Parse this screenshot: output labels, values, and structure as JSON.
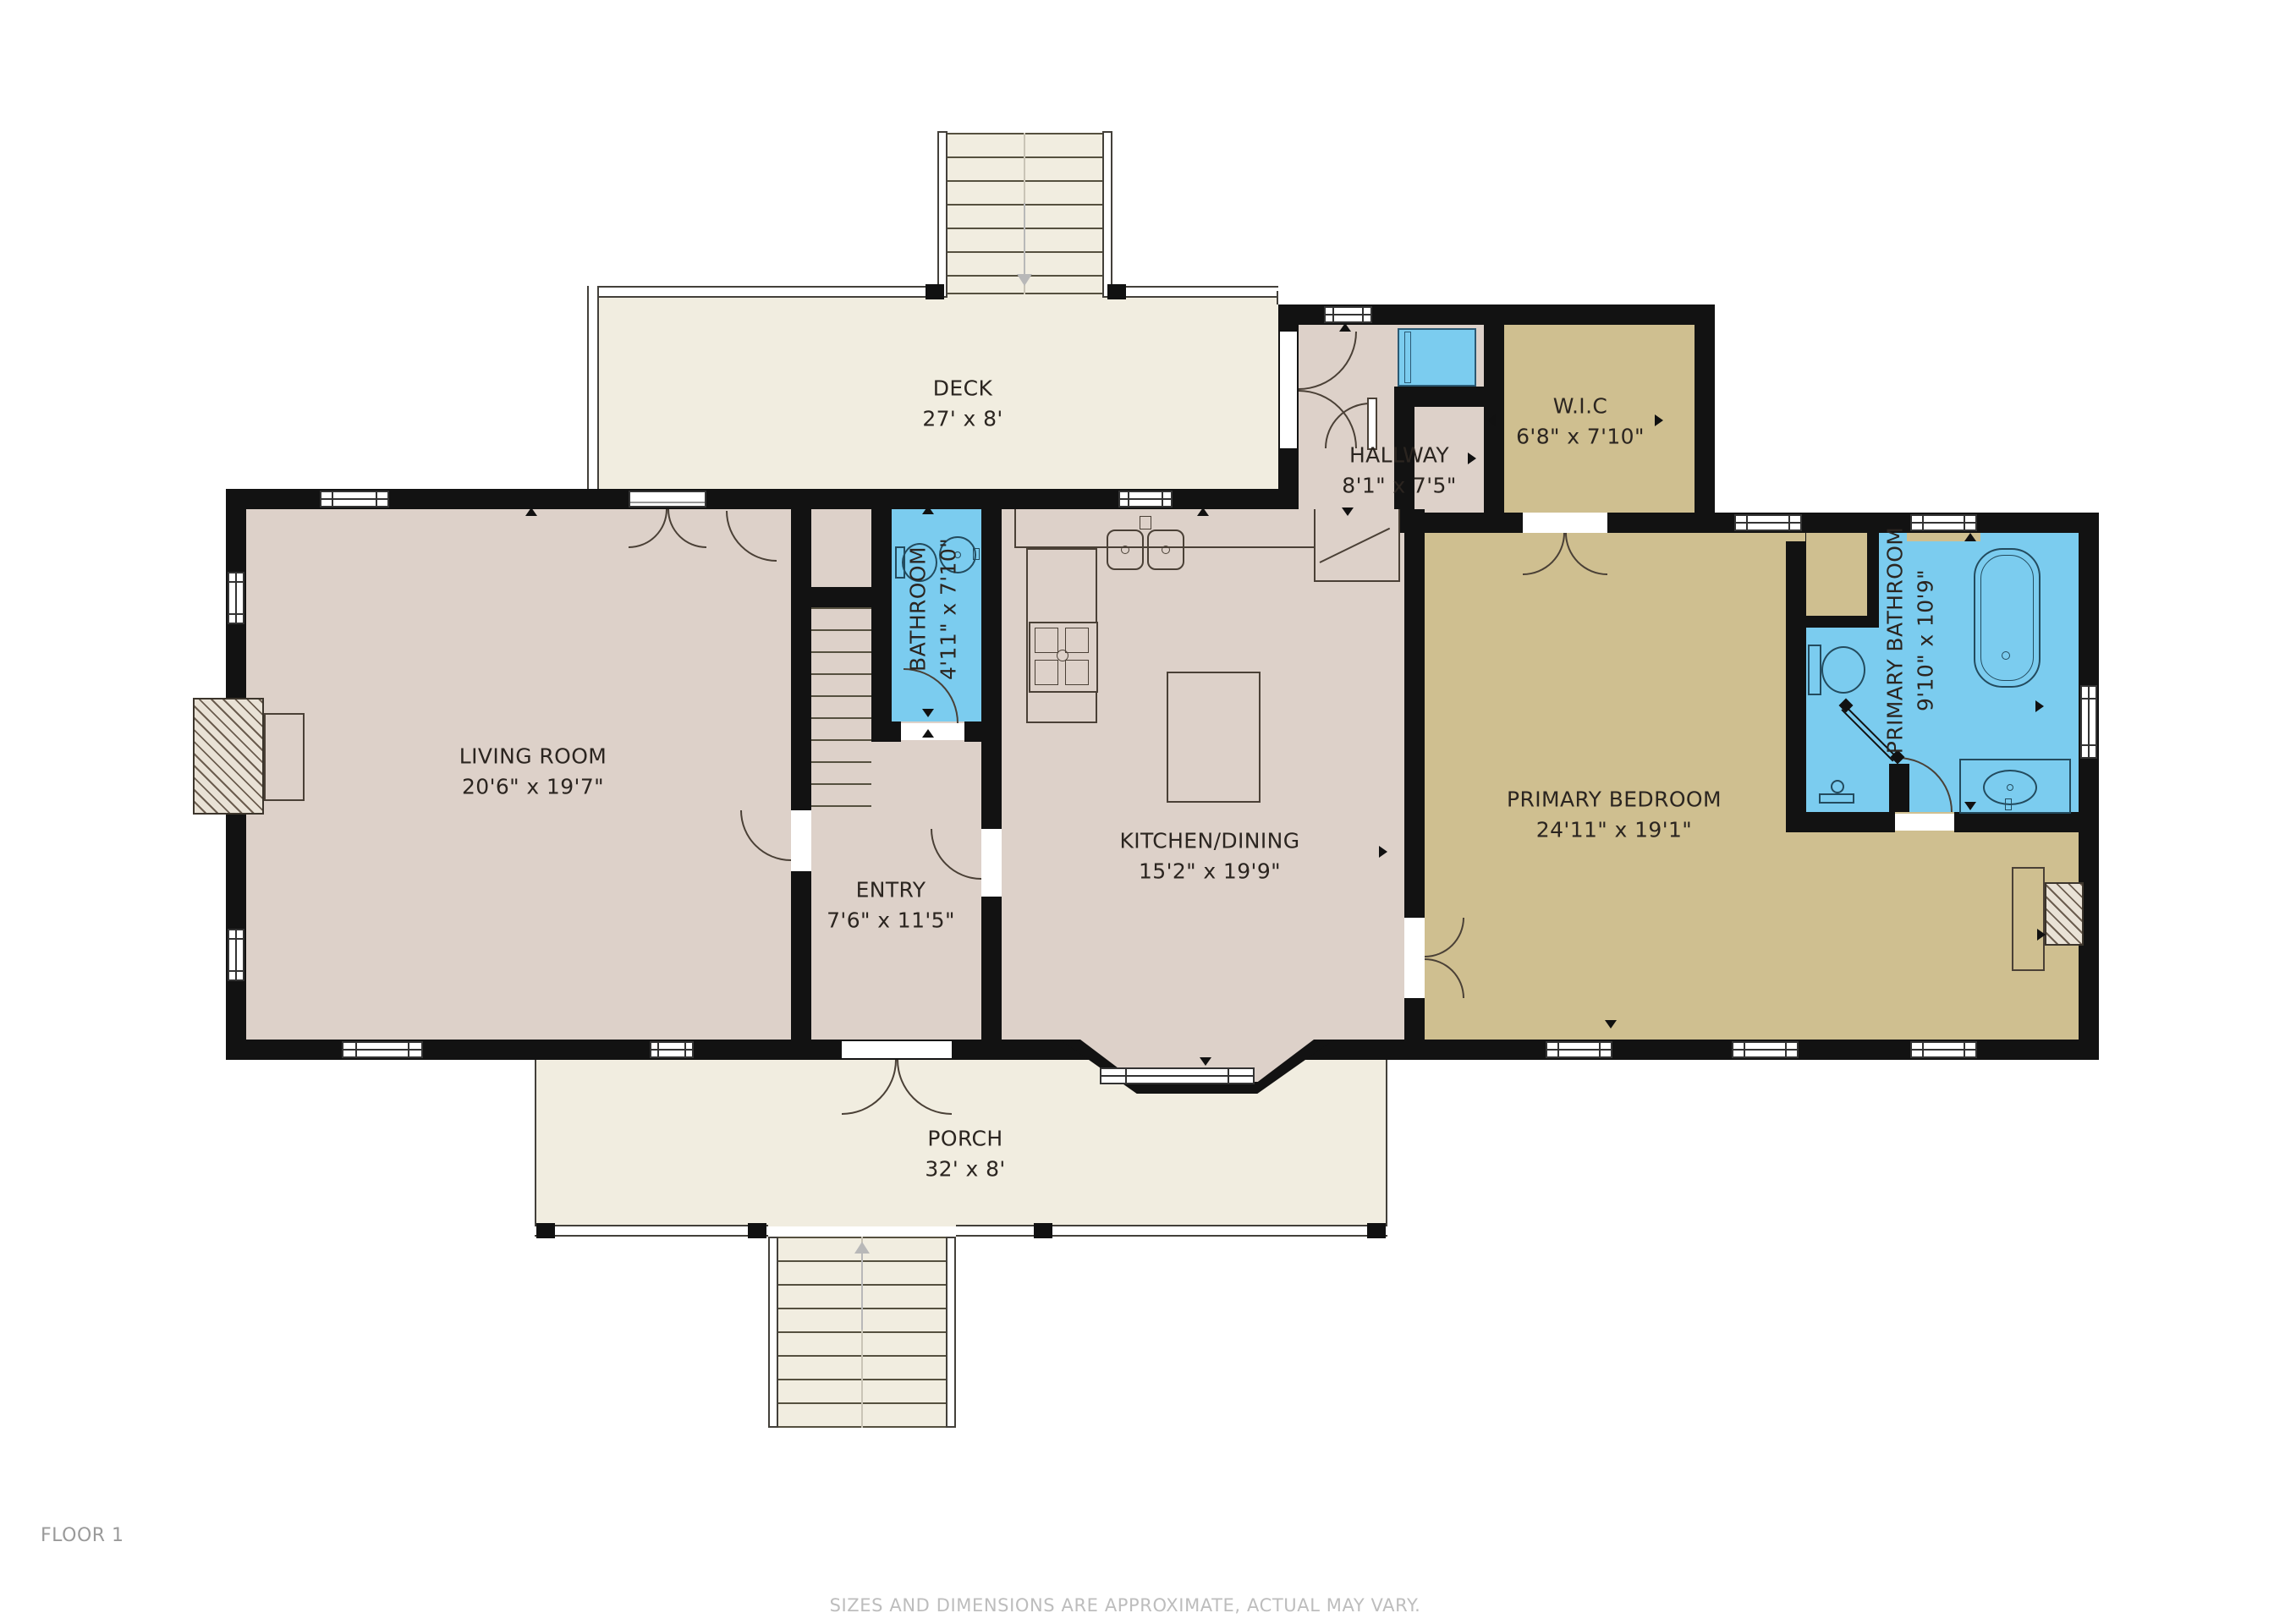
{
  "plan": {
    "floor_label": "FLOOR 1",
    "disclaimer": "SIZES AND DIMENSIONS ARE APPROXIMATE, ACTUAL MAY VARY."
  },
  "rooms": {
    "deck": {
      "name": "DECK",
      "dims": "27' x 8'"
    },
    "hallway": {
      "name": "HALLWAY",
      "dims": "8'1\" x 7'5\""
    },
    "wic": {
      "name": "W.I.C",
      "dims": "6'8\" x 7'10\""
    },
    "bathroom": {
      "name": "BATHROOM",
      "dims": "4'11\" x 7'10\""
    },
    "living_room": {
      "name": "LIVING ROOM",
      "dims": "20'6\" x 19'7\""
    },
    "kitchen_dining": {
      "name": "KITCHEN/DINING",
      "dims": "15'2\" x 19'9\""
    },
    "entry": {
      "name": "ENTRY",
      "dims": "7'6\" x 11'5\""
    },
    "primary_bedroom": {
      "name": "PRIMARY BEDROOM",
      "dims": "24'11\" x 19'1\""
    },
    "primary_bathroom": {
      "name": "PRIMARY BATHROOM",
      "dims": "9'10\" x 10'9\""
    },
    "porch": {
      "name": "PORCH",
      "dims": "32' x 8'"
    }
  },
  "colors": {
    "wall": "#121212",
    "floor_warm": "#ddd1c9",
    "floor_tan": "#cfbf90",
    "bath_blue": "#7bccef",
    "deck_cream": "#f1ede0",
    "fixture_line": "#4a4036",
    "bath_fixture_line": "#234b5e",
    "text": "#2b2520"
  }
}
